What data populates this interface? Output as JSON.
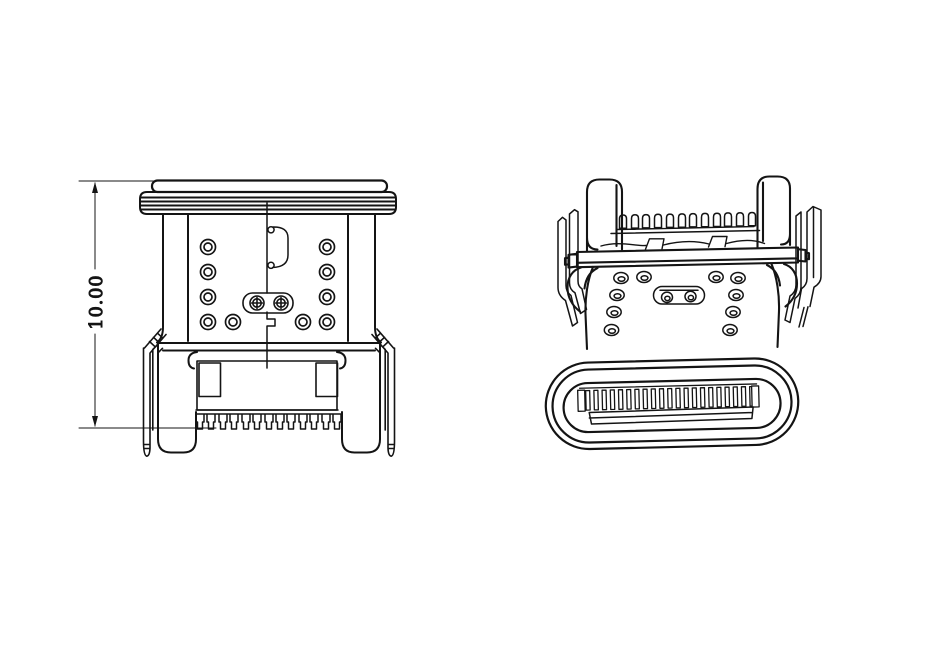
{
  "canvas": {
    "width_px": 935,
    "height_px": 649,
    "background": "#ffffff",
    "line_color": "#141414"
  },
  "front_view": {
    "dimension_label": "10.00"
  }
}
